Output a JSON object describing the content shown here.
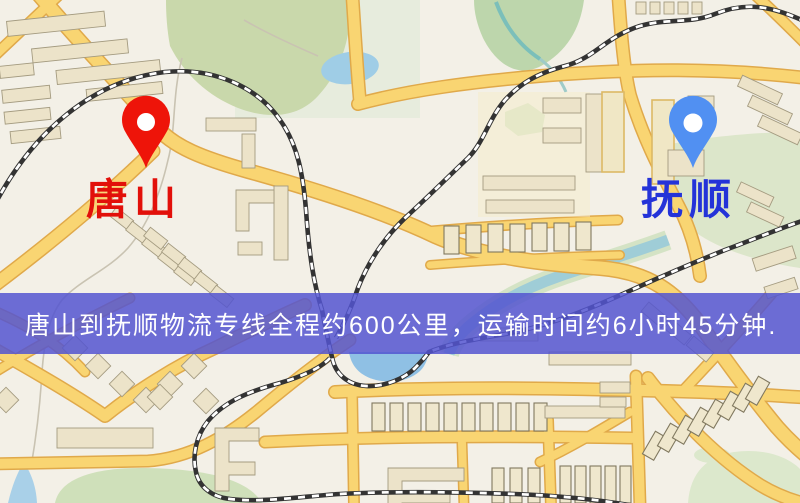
{
  "map": {
    "type": "road-map",
    "pins": {
      "origin": {
        "label": "唐山",
        "pin_color": "#ee1409",
        "label_color": "#e2100a",
        "icon": "location-pin-icon"
      },
      "destination": {
        "label": "抚顺",
        "pin_color": "#5190f2",
        "label_color": "#2433d8",
        "icon": "location-pin-icon"
      }
    },
    "palette": {
      "background": "#f3f0e7",
      "road_fill": "#f9d572",
      "road_casing": "#e0a94a",
      "building_fill": "#ece3c9",
      "railway_dark": "#333333",
      "water": "#9fcde6",
      "park": "#c9d8ab"
    }
  },
  "banner": {
    "text": "唐山到抚顺物流专线全程约600公里，运输时间约6小时45分钟.",
    "background_color": "rgba(84,85,208,0.85)",
    "text_color": "#ffffff"
  }
}
